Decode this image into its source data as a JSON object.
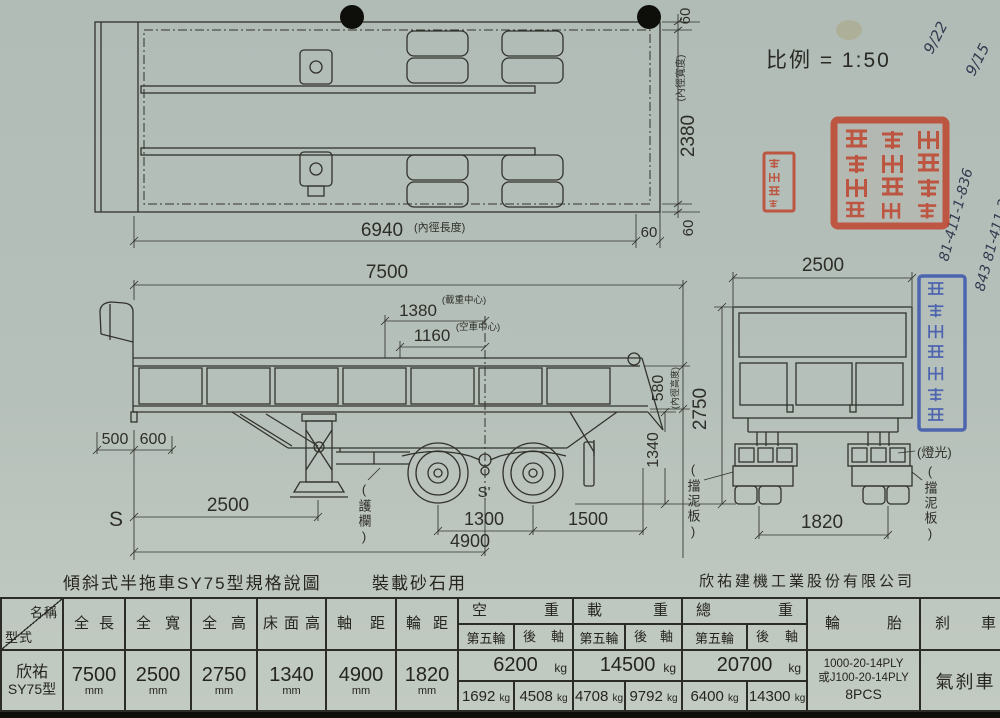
{
  "scale_label": "比例 = 1:50",
  "captions": {
    "drawing_title": "傾斜式半拖車SY75型規格說圖",
    "purpose": "裝載砂石用",
    "company": "欣祐建機工業股份有限公司"
  },
  "top_view": {
    "wall_top": "60",
    "inner_width": "2380",
    "inner_width_note": "(內徑寬度)",
    "inner_length": "6940",
    "inner_length_note": "(內徑長度)",
    "wall_end": "60",
    "wall_bottom": "60"
  },
  "side_view": {
    "overall_length": "7500",
    "load_center": "1380",
    "load_center_note": "(載重中心)",
    "empty_center": "1160",
    "empty_center_note": "(空車中心)",
    "front_a": "500",
    "front_b": "600",
    "kingpin_label": "S",
    "tandem_label": "S'",
    "gear_distance": "2500",
    "axle_spread": "1300",
    "rear_distance": "1500",
    "wheelbase": "4900",
    "floor_height": "1340",
    "inner_height": "580",
    "inner_height_note": "(內徑高度)",
    "guard_note": "(護欄)",
    "mudflap_note": "(擋泥板)"
  },
  "rear_view": {
    "overall_width": "2500",
    "track": "1820",
    "overall_height": "2750",
    "lights_note": "(燈光)",
    "mudflap_note": "(擋泥板)"
  },
  "handwriting": {
    "date1": "9/22",
    "date2": "9/15",
    "ref1": "81-411-1-836",
    "ref2": "843 81-411-2-315"
  },
  "colors": {
    "paper": "#b6c0ba",
    "ink": "#32322d",
    "seal_red": "#bf4028",
    "seal_blue": "#3c56ae"
  },
  "table": {
    "corner_top": "名稱",
    "corner_bottom": "型式",
    "headers": {
      "length": "全長",
      "width": "全寬",
      "height": "全高",
      "floor": "床面高",
      "wheelbase": "軸距",
      "track": "輪距",
      "empty": "空重",
      "load": "載重",
      "gross": "總重",
      "fifth": "第五輪",
      "rear_axle": "後軸",
      "tire": "輪胎",
      "brake": "刹車"
    },
    "maker": "欣祐",
    "model": "SY75型",
    "unit_mm": "mm",
    "unit_kg": "kg",
    "values": {
      "length": "7500",
      "width": "2500",
      "height": "2750",
      "floor": "1340",
      "wheelbase": "4900",
      "track": "1820",
      "empty_total": "6200",
      "empty_fifth": "1692",
      "empty_rear": "4508",
      "load_total": "14500",
      "load_fifth": "4708",
      "load_rear": "9792",
      "gross_total": "20700",
      "gross_fifth": "6400",
      "gross_rear": "14300",
      "tire1": "1000-20-14PLY",
      "tire2": "或J100-20-14PLY",
      "tire3": "8PCS",
      "brake": "氣刹車"
    }
  }
}
